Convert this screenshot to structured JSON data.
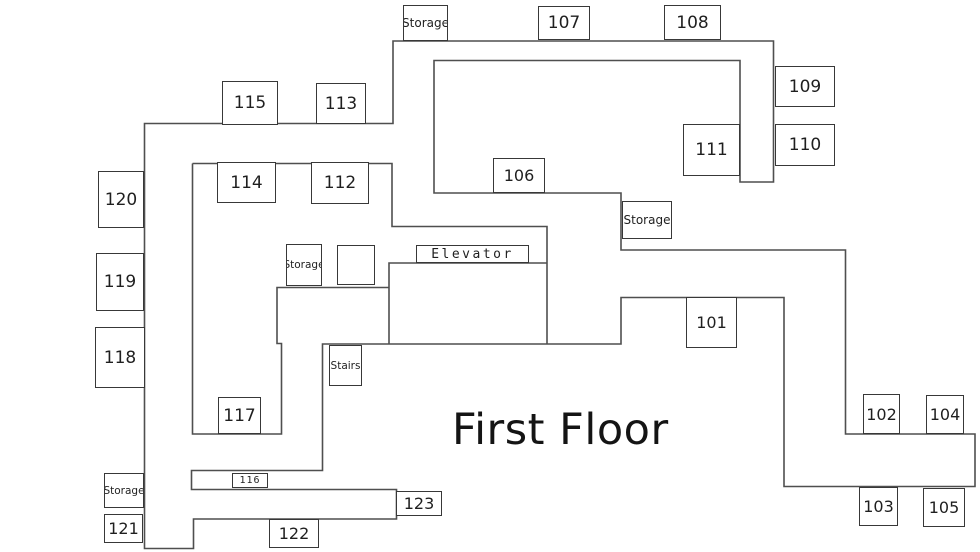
{
  "title": "First Floor",
  "colors": {
    "background": "#ffffff",
    "wall": "#4f4f4f",
    "box_border": "#383838",
    "text": "#1f1f1f"
  },
  "floorplan": {
    "outline": [
      [
        144.5,
        548.5
      ],
      [
        144.5,
        123.5
      ],
      [
        393,
        123.5
      ],
      [
        393,
        41
      ],
      [
        773.5,
        41
      ],
      [
        773.5,
        182
      ],
      [
        740,
        182
      ],
      [
        740,
        60.5
      ],
      [
        434,
        60.5
      ],
      [
        434,
        193
      ],
      [
        621,
        193
      ],
      [
        621,
        250
      ],
      [
        845.5,
        250
      ],
      [
        845.5,
        434
      ],
      [
        975,
        434
      ],
      [
        975,
        486.5
      ],
      [
        784,
        486.5
      ],
      [
        784,
        297.5
      ],
      [
        621,
        297.5
      ],
      [
        621,
        344
      ],
      [
        322.5,
        344
      ],
      [
        322.5,
        470.5
      ],
      [
        191.5,
        470.5
      ],
      [
        191.5,
        489.5
      ],
      [
        396.5,
        489.5
      ],
      [
        396.5,
        519
      ],
      [
        193.5,
        519
      ],
      [
        193.5,
        548.5
      ]
    ],
    "inner_walls": [
      [
        [
          192.5,
          163.5
        ],
        [
          392,
          163.5
        ],
        [
          392,
          226.5
        ],
        [
          547,
          226.5
        ],
        [
          547,
          344
        ]
      ],
      [
        [
          192.5,
          163.5
        ],
        [
          192.5,
          434
        ],
        [
          281.5,
          434
        ],
        [
          281.5,
          343.5
        ],
        [
          277,
          343.5
        ],
        [
          277,
          287.5
        ],
        [
          389,
          287.5
        ]
      ],
      [
        [
          389,
          344
        ],
        [
          389,
          263
        ],
        [
          547,
          263
        ]
      ]
    ],
    "rooms": [
      {
        "name": "storage-north",
        "label": "Storage",
        "x": 403,
        "y": 5,
        "w": 45,
        "h": 36,
        "fs": 12
      },
      {
        "name": "room-107",
        "label": "107",
        "x": 538,
        "y": 6,
        "w": 52,
        "h": 34,
        "fs": 17
      },
      {
        "name": "room-108",
        "label": "108",
        "x": 664,
        "y": 5,
        "w": 57,
        "h": 35,
        "fs": 17
      },
      {
        "name": "room-109",
        "label": "109",
        "x": 775,
        "y": 66,
        "w": 60,
        "h": 41,
        "fs": 17
      },
      {
        "name": "room-110",
        "label": "110",
        "x": 775,
        "y": 124,
        "w": 60,
        "h": 42,
        "fs": 17
      },
      {
        "name": "room-111",
        "label": "111",
        "x": 683,
        "y": 124,
        "w": 57,
        "h": 52,
        "fs": 17
      },
      {
        "name": "room-115",
        "label": "115",
        "x": 222,
        "y": 81,
        "w": 56,
        "h": 44,
        "fs": 17
      },
      {
        "name": "room-113",
        "label": "113",
        "x": 316,
        "y": 83,
        "w": 50,
        "h": 41,
        "fs": 17
      },
      {
        "name": "room-114",
        "label": "114",
        "x": 217,
        "y": 162,
        "w": 59,
        "h": 41,
        "fs": 17
      },
      {
        "name": "room-112",
        "label": "112",
        "x": 311,
        "y": 162,
        "w": 58,
        "h": 42,
        "fs": 17
      },
      {
        "name": "room-106",
        "label": "106",
        "x": 493,
        "y": 158,
        "w": 52,
        "h": 35,
        "fs": 16
      },
      {
        "name": "storage-east",
        "label": "Storage",
        "x": 622,
        "y": 201,
        "w": 50,
        "h": 38,
        "fs": 12
      },
      {
        "name": "room-120",
        "label": "120",
        "x": 98,
        "y": 171,
        "w": 46,
        "h": 57,
        "fs": 17
      },
      {
        "name": "room-119",
        "label": "119",
        "x": 96,
        "y": 253,
        "w": 48,
        "h": 58,
        "fs": 17
      },
      {
        "name": "room-118",
        "label": "118",
        "x": 95,
        "y": 327,
        "w": 50,
        "h": 61,
        "fs": 17
      },
      {
        "name": "storage-center",
        "label": "Storage",
        "x": 286,
        "y": 244,
        "w": 36,
        "h": 42,
        "fs": 10.5
      },
      {
        "name": "utility-box",
        "label": "",
        "x": 337,
        "y": 245,
        "w": 38,
        "h": 40,
        "fs": 12
      },
      {
        "name": "elevator",
        "label": "Elevator",
        "x": 416,
        "y": 245,
        "w": 113,
        "h": 18,
        "fs": 13,
        "ls": 2.5,
        "mono": true
      },
      {
        "name": "room-101",
        "label": "101",
        "x": 686,
        "y": 297,
        "w": 51,
        "h": 51,
        "fs": 16
      },
      {
        "name": "stairs",
        "label": "Stairs",
        "x": 329,
        "y": 345,
        "w": 33,
        "h": 41,
        "fs": 10.5
      },
      {
        "name": "room-117",
        "label": "117",
        "x": 218,
        "y": 397,
        "w": 43,
        "h": 37,
        "fs": 17
      },
      {
        "name": "room-102",
        "label": "102",
        "x": 863,
        "y": 394,
        "w": 37,
        "h": 40,
        "fs": 16
      },
      {
        "name": "room-104",
        "label": "104",
        "x": 926,
        "y": 395,
        "w": 38,
        "h": 39,
        "fs": 16
      },
      {
        "name": "room-116",
        "label": "116",
        "x": 232,
        "y": 473,
        "w": 36,
        "h": 15,
        "fs": 10,
        "ls": 1,
        "mono": true
      },
      {
        "name": "room-123",
        "label": "123",
        "x": 396,
        "y": 491,
        "w": 46,
        "h": 25,
        "fs": 16
      },
      {
        "name": "storage-west",
        "label": "Storage",
        "x": 104,
        "y": 473,
        "w": 40,
        "h": 35,
        "fs": 10.5
      },
      {
        "name": "room-121",
        "label": "121",
        "x": 104,
        "y": 514,
        "w": 39,
        "h": 29,
        "fs": 16
      },
      {
        "name": "room-122",
        "label": "122",
        "x": 269,
        "y": 519,
        "w": 50,
        "h": 29,
        "fs": 16
      },
      {
        "name": "room-103",
        "label": "103",
        "x": 859,
        "y": 487,
        "w": 39,
        "h": 39,
        "fs": 16
      },
      {
        "name": "room-105",
        "label": "105",
        "x": 923,
        "y": 488,
        "w": 42,
        "h": 39,
        "fs": 16
      }
    ],
    "title_pos": {
      "x": 452,
      "y": 405
    }
  }
}
